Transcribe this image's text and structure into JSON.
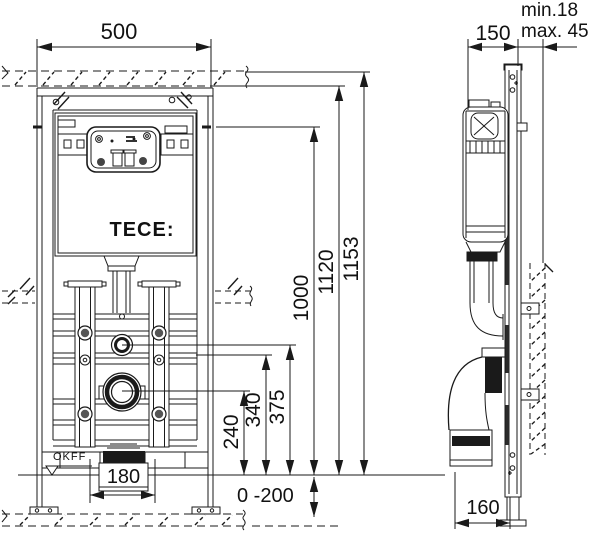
{
  "front_view": {
    "logo": "TECE:",
    "floor_label": "OKFF",
    "dims": {
      "width": "500",
      "total_height": "1153",
      "frame_height": "1120",
      "height_1000": "1000",
      "supply_height": "375",
      "rail_height": "340",
      "drain_height": "240",
      "flush_width": "180",
      "floor_range": "0 -200"
    }
  },
  "side_view": {
    "dims": {
      "depth": "150",
      "wall_min": "min.18",
      "wall_max": "max. 45",
      "drain_offset": "160"
    }
  },
  "colors": {
    "line": "#1a1a1a",
    "background": "#ffffff"
  }
}
